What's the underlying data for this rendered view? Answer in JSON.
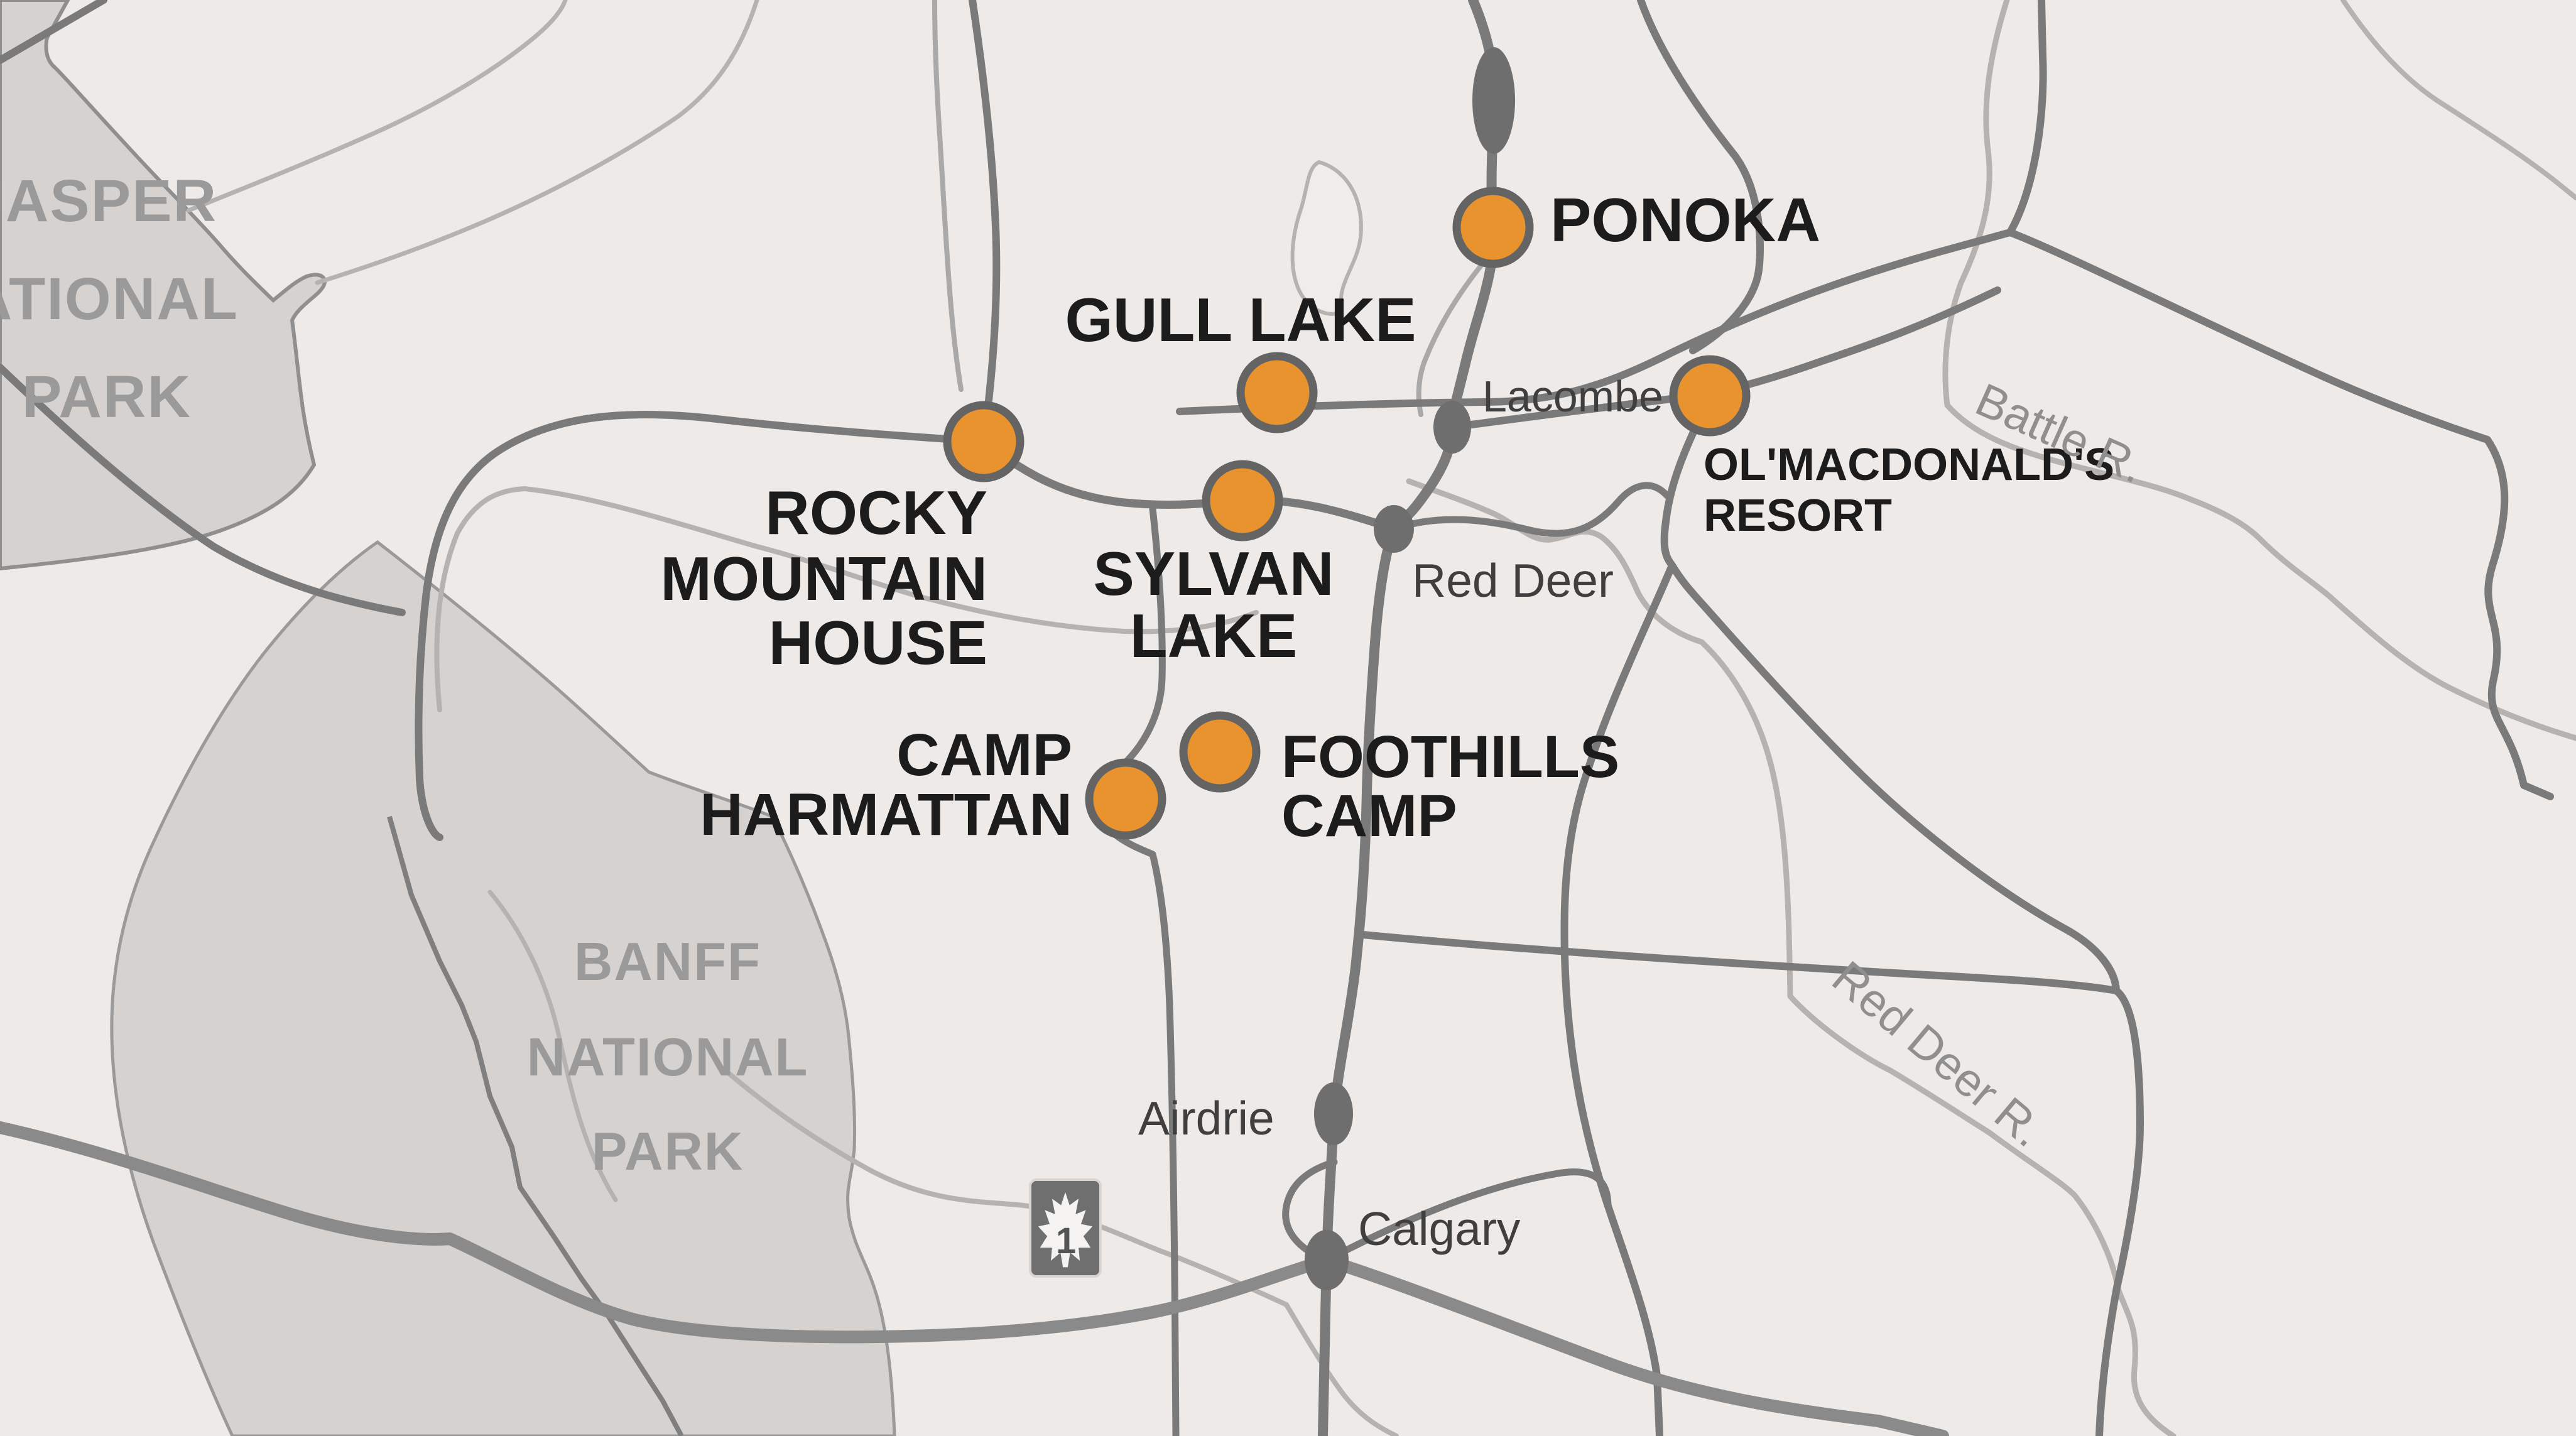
{
  "map": {
    "type": "regional-locator-map",
    "region": "Central Alberta, Canada",
    "colors": {
      "background": "#edeae7",
      "park_fill": "#d5d2cf",
      "park_stroke": "#8f8f8f",
      "park_label": "#9a9a9a",
      "road": "#7a7a7a",
      "road_thin": "#a9a9a9",
      "river": "#b5b2af",
      "trans_canada": "#8a8a8a",
      "marker_fill": "#e8932e",
      "marker_stroke": "#646464",
      "city_dot": "#6e6e6e",
      "poi_text": "#1c1c1c",
      "city_text": "#3f3f3f",
      "river_text": "#8f8f8f",
      "shield_fill": "#6f6f6f",
      "shield_leaf": "#f5f3f1"
    },
    "locations": [
      {
        "id": "ponoka",
        "lines": [
          "PONOKA"
        ]
      },
      {
        "id": "gull-lake",
        "lines": [
          "GULL LAKE"
        ]
      },
      {
        "id": "sylvan-lake",
        "lines": [
          "SYLVAN",
          "LAKE"
        ]
      },
      {
        "id": "rocky-mountain-house",
        "lines": [
          "ROCKY",
          "MOUNTAIN",
          "HOUSE"
        ]
      },
      {
        "id": "olmacdonalds-resort",
        "lines": [
          "OL'MACDONALD'S",
          "RESORT"
        ]
      },
      {
        "id": "camp-harmattan",
        "lines": [
          "CAMP",
          "HARMATTAN"
        ]
      },
      {
        "id": "foothills-camp",
        "lines": [
          "FOOTHILLS",
          "CAMP"
        ]
      }
    ],
    "cities": [
      {
        "name": "Lacombe"
      },
      {
        "name": "Red Deer"
      },
      {
        "name": "Airdrie"
      },
      {
        "name": "Calgary"
      }
    ],
    "parks": [
      {
        "id": "jasper",
        "lines": [
          "JASPER",
          "NATIONAL",
          "PARK"
        ]
      },
      {
        "id": "banff",
        "lines": [
          "BANFF",
          "NATIONAL",
          "PARK"
        ]
      }
    ],
    "rivers": [
      {
        "name": "Battle R."
      },
      {
        "name": "Red Deer R."
      },
      {
        "name": "B"
      }
    ],
    "highway_shield": {
      "number": "1"
    }
  }
}
